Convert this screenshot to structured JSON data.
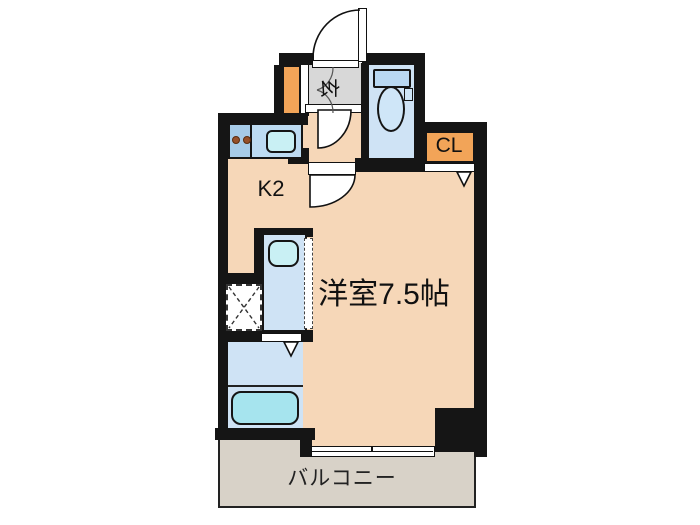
{
  "plan": {
    "type": "apartment-floor-plan",
    "rooms": {
      "genkan": {
        "label": "玄"
      },
      "kitchen": {
        "label": "K2"
      },
      "closet": {
        "label": "CL"
      },
      "main_room": {
        "label": "洋室7.5帖"
      },
      "balcony": {
        "label": "バルコニー"
      }
    },
    "fixtures": [
      "entrance-door",
      "shoe-cabinet",
      "toilet",
      "kitchen-counter",
      "gas-stove-burners",
      "kitchen-sink",
      "washbasin-unit",
      "washing-machine-space",
      "bathtub",
      "sliding-window",
      "pipe-space"
    ],
    "colors": {
      "wall": "#151515",
      "room_floor": "#f6d7b8",
      "genkan_floor": "#d8d8d8",
      "wet_area_floor": "#cfe3f5",
      "storage_orange": "#f2a458",
      "balcony_floor": "#d8d2c8",
      "bathtub_fill": "#a6e4ee",
      "sink_fill": "#c9f0f4",
      "counter_left": "#a6cbe8",
      "counter_right": "#bddbf2",
      "background": "#ffffff"
    }
  }
}
